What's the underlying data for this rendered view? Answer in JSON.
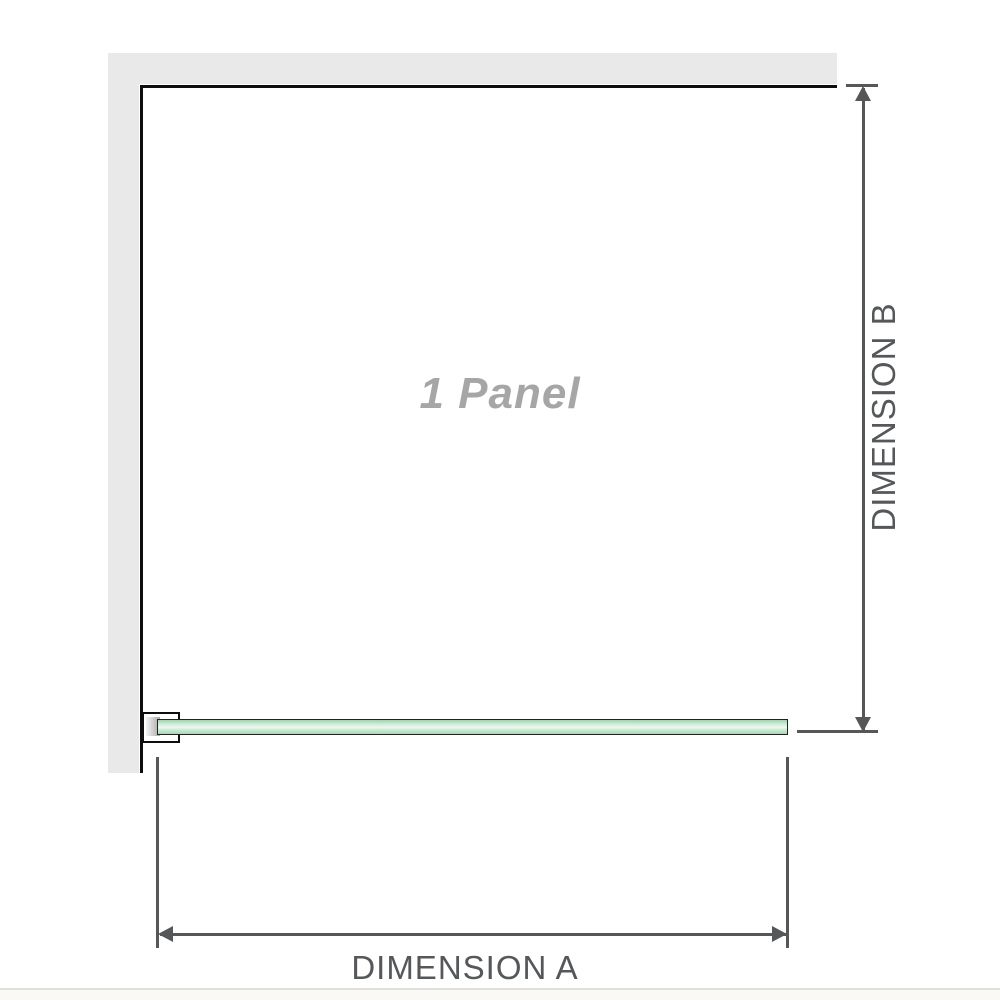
{
  "diagram": {
    "panel_label": "1 Panel",
    "dimension_a_label": "DIMENSION A",
    "dimension_b_label": "DIMENSION B"
  },
  "colors": {
    "wall-fill": "#e9e9e9",
    "frame-line": "#0d0d0d",
    "dimension-line": "#555759",
    "dimension-text": "#55575a",
    "panel-text": "#a6a6a6",
    "glass-border": "#222222",
    "glass-top": "#9fd3ae",
    "glass-light": "#eef8f1",
    "glass-bottom": "#a9d8b7",
    "divider": "#e0ded8",
    "footer-bg": "#faf9f6"
  }
}
